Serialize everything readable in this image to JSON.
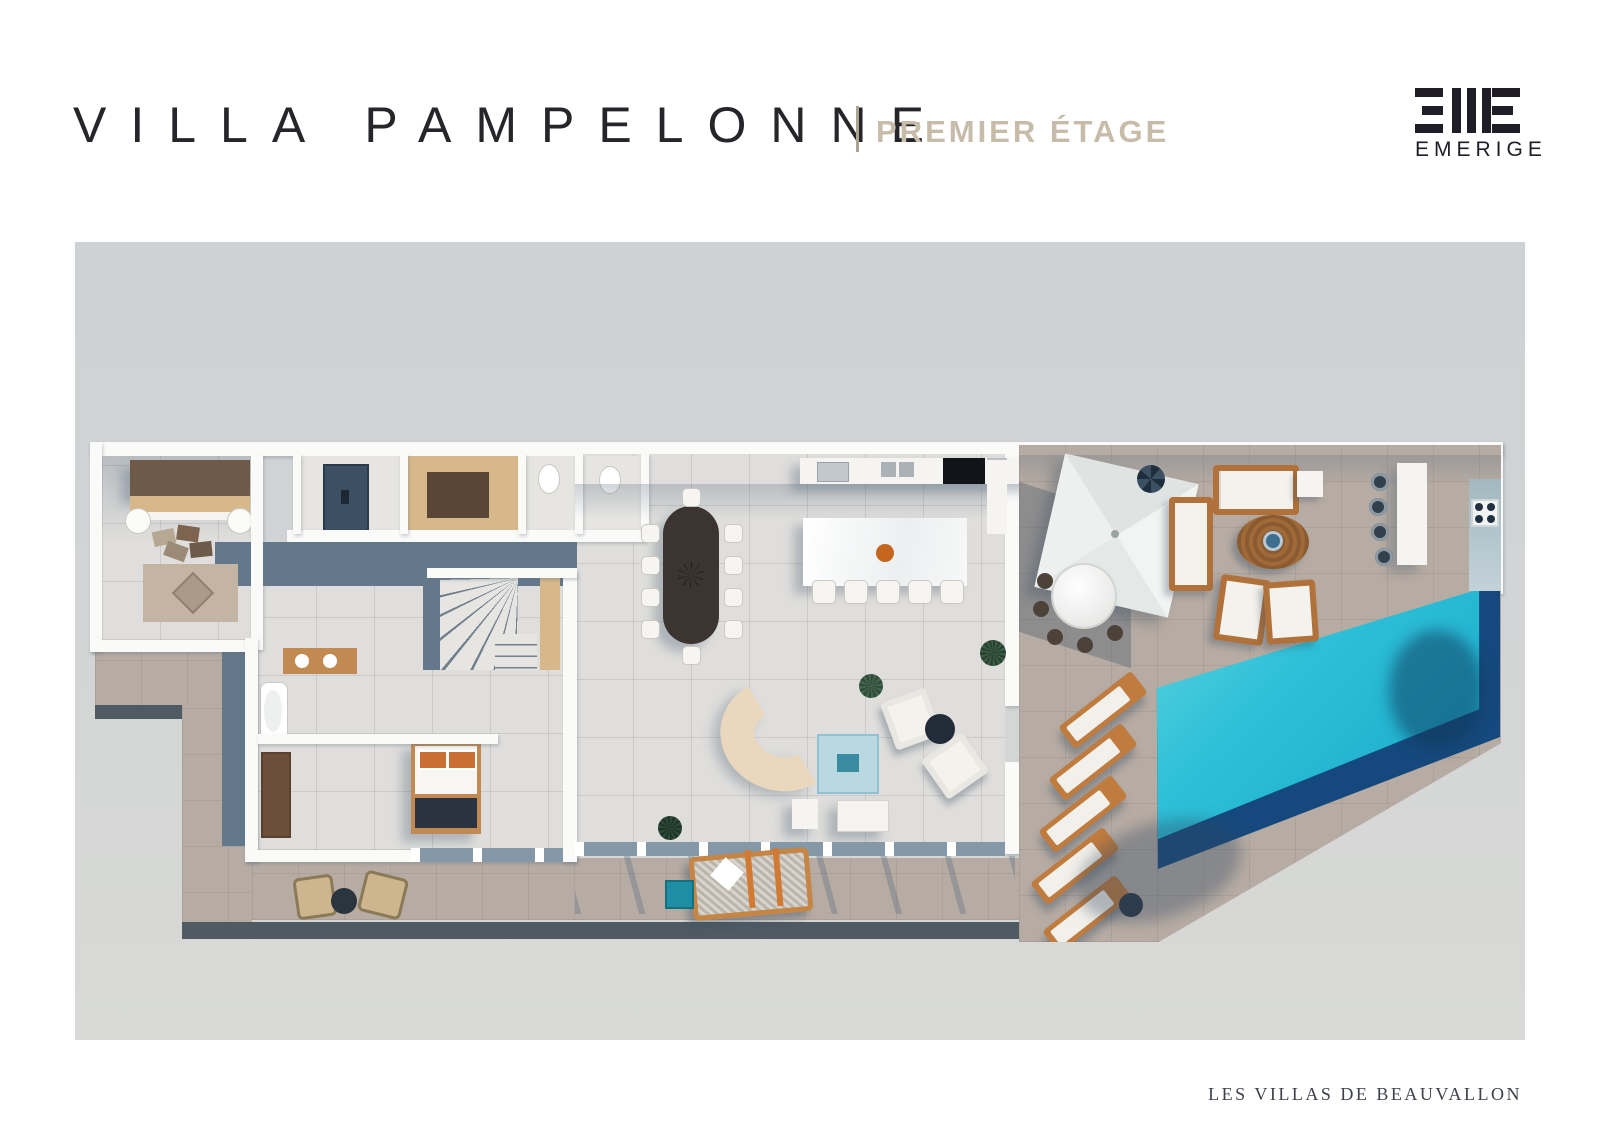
{
  "header": {
    "title": "VILLA PAMPELONNE",
    "title_color": "#26262a",
    "subtitle": "PREMIER ÉTAGE",
    "subtitle_color": "#c7bcaa"
  },
  "logo": {
    "wordmark": "EMERIGE",
    "color": "#211d26",
    "mark": "three-horizontal-bars | three-vertical-bars | three-horizontal-bars-mirrored"
  },
  "footer": {
    "text": "LES VILLAS DE BEAUVALLON",
    "color": "#3c414b"
  },
  "plan": {
    "kind": "aerial-3d-floor-plan-render",
    "floor_shown": "premier étage",
    "background_top": "#ced2d4",
    "background_bottom": "#d9dad7",
    "colors": {
      "walls": "#fafaf9",
      "interior_tile": "#dfdedc",
      "slate_floor": "#64788b",
      "terrace_stone": "#b7aca3",
      "deck_edge": "#4f5a63",
      "pool_water": "#25b5d2",
      "pool_deep": "#15497d",
      "wood_light": "#d7b88a",
      "wood_mid": "#c08a52",
      "wood_dark": "#6e5a48",
      "accent_orange": "#c5661f"
    },
    "visible_features": [
      "lounge-room",
      "elevator",
      "dressing-room",
      "wc",
      "staircase",
      "corridor",
      "bathroom",
      "bedroom",
      "dining-table-10-seats",
      "kitchen-counter",
      "kitchen-island-5-stools",
      "curved-sofa",
      "blue-rug",
      "armchairs",
      "terrace",
      "pergola",
      "outdoor-dining-table",
      "outdoor-sofa",
      "round-coffee-table",
      "bar-counter-4-stools",
      "outdoor-kitchen",
      "infinity-pool",
      "five-sun-loungers",
      "hammock-daybed",
      "wicker-chairs",
      "planters"
    ]
  }
}
